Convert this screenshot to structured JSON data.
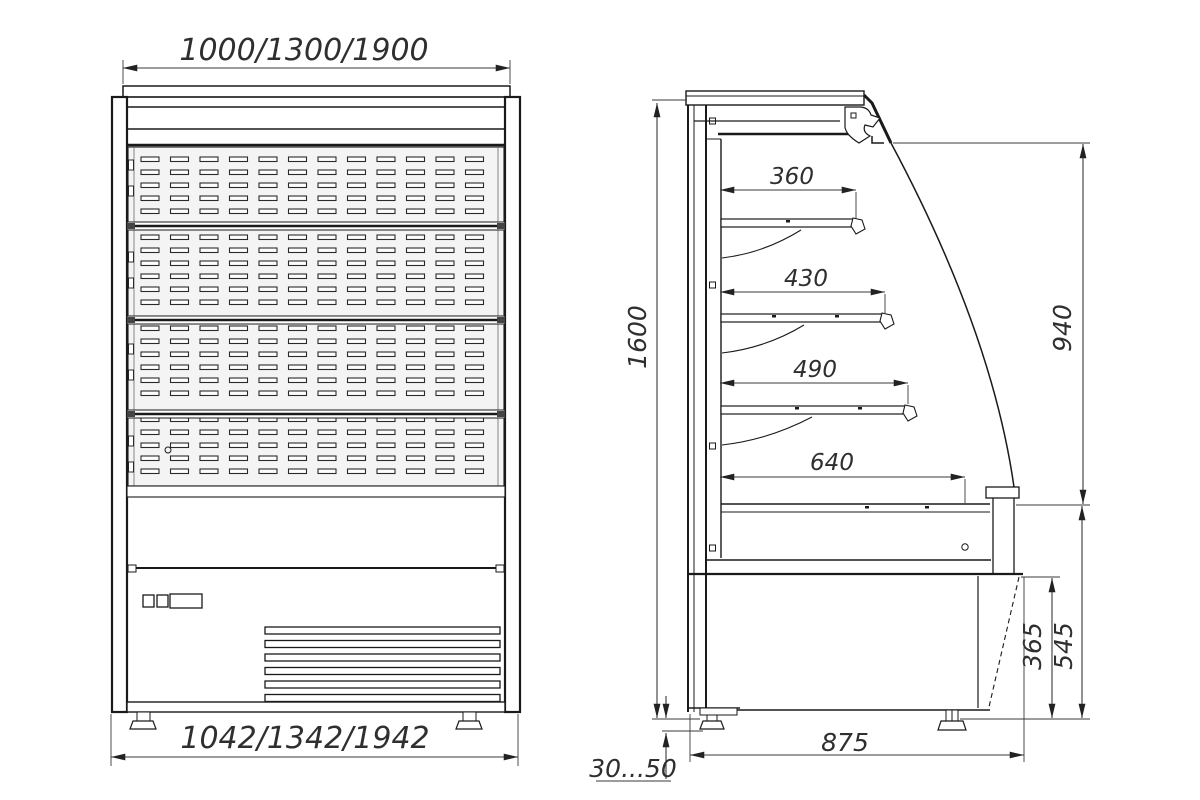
{
  "drawing": {
    "background": "#ffffff",
    "line_color": "#1a1a1a",
    "dim_color": "#3a3a3a",
    "text_color": "#2f2f2f",
    "panel_fill": "#f4f4f4",
    "front_view": {
      "width_top_label": "1000/1300/1900",
      "width_bottom_label": "1042/1342/1942"
    },
    "side_view": {
      "height_label": "1600",
      "opening_height_label": "940",
      "shelf_depth_labels": [
        "360",
        "430",
        "490",
        "640"
      ],
      "base_front_height_label": "365",
      "base_total_height_label": "545",
      "depth_label": "875",
      "foot_adjust_label": "30...50"
    }
  }
}
